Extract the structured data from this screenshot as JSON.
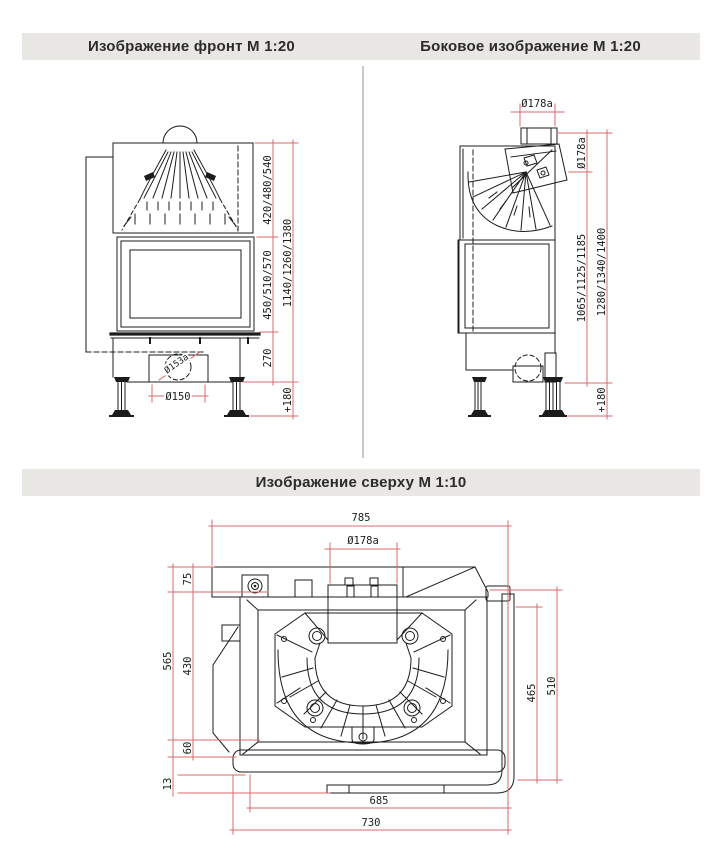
{
  "headers": {
    "front": "Изображение фронт М 1:20",
    "side": "Боковое изображение М 1:20",
    "top": "Изображение сверху М 1:10"
  },
  "colors": {
    "dimension_red": "#d96a6a",
    "line_black": "#1c1c1c",
    "header_bg": "#e9e7e4",
    "divider": "#c9c9c9"
  },
  "front_view": {
    "dims": {
      "dome": "420/480/540",
      "glass": "450/510/570",
      "total": "1140/1260/1380",
      "plinth": "270",
      "legs": "+180",
      "air_duct": "Ø150",
      "air_collar": "Ø153a"
    }
  },
  "side_view": {
    "dims": {
      "flue_width": "Ø178a",
      "flue_height": "Ø178a",
      "body": "1065/1125/1185",
      "total": "1280/1340/1400",
      "legs": "+180"
    }
  },
  "top_view": {
    "dims": {
      "width": "785",
      "flue": "Ø178a",
      "front_edge": "75",
      "depth": "565",
      "body_depth": "430",
      "rear_edge": "60",
      "lip": "13",
      "inner_width": "685",
      "base_width": "730",
      "side_inner": "465",
      "side_outer": "510"
    }
  }
}
